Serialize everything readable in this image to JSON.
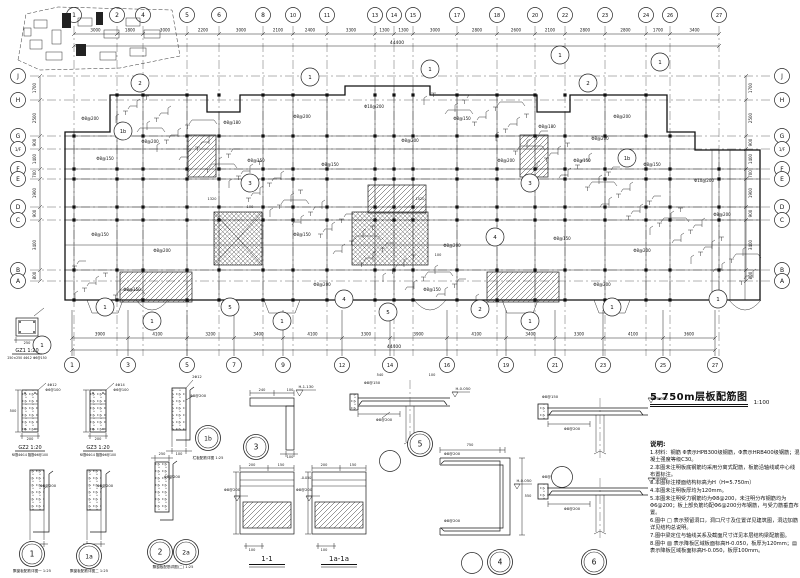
{
  "title_block": {
    "text": "5.750m层板配筋图",
    "scale": "1:100"
  },
  "grid": {
    "top": [
      {
        "l": "1",
        "x": 74
      },
      {
        "l": "2",
        "x": 117
      },
      {
        "l": "4",
        "x": 143
      },
      {
        "l": "5",
        "x": 187
      },
      {
        "l": "6",
        "x": 219
      },
      {
        "l": "8",
        "x": 263
      },
      {
        "l": "10",
        "x": 293
      },
      {
        "l": "11",
        "x": 327
      },
      {
        "l": "13",
        "x": 375
      },
      {
        "l": "14",
        "x": 394
      },
      {
        "l": "15",
        "x": 413
      },
      {
        "l": "17",
        "x": 457
      },
      {
        "l": "18",
        "x": 497
      },
      {
        "l": "20",
        "x": 535
      },
      {
        "l": "22",
        "x": 565
      },
      {
        "l": "23",
        "x": 605
      },
      {
        "l": "24",
        "x": 646
      },
      {
        "l": "26",
        "x": 670
      },
      {
        "l": "27",
        "x": 719
      }
    ],
    "bottom": [
      {
        "l": "1",
        "x": 72
      },
      {
        "l": "3",
        "x": 128
      },
      {
        "l": "5",
        "x": 187
      },
      {
        "l": "7",
        "x": 234
      },
      {
        "l": "9",
        "x": 283
      },
      {
        "l": "12",
        "x": 342
      },
      {
        "l": "14",
        "x": 390
      },
      {
        "l": "16",
        "x": 447
      },
      {
        "l": "19",
        "x": 506
      },
      {
        "l": "21",
        "x": 555
      },
      {
        "l": "23",
        "x": 603
      },
      {
        "l": "25",
        "x": 663
      },
      {
        "l": "27",
        "x": 715
      }
    ],
    "left": [
      {
        "l": "J",
        "y": 76
      },
      {
        "l": "H",
        "y": 100
      },
      {
        "l": "G",
        "y": 136
      },
      {
        "l": "1/F",
        "y": 149
      },
      {
        "l": "F",
        "y": 169
      },
      {
        "l": "E",
        "y": 179
      },
      {
        "l": "D",
        "y": 207
      },
      {
        "l": "C",
        "y": 220
      },
      {
        "l": "B",
        "y": 270
      },
      {
        "l": "A",
        "y": 281
      }
    ],
    "right": [
      {
        "l": "J",
        "y": 76
      },
      {
        "l": "H",
        "y": 100
      },
      {
        "l": "G",
        "y": 136
      },
      {
        "l": "1/F",
        "y": 149
      },
      {
        "l": "F",
        "y": 169
      },
      {
        "l": "E",
        "y": 179
      },
      {
        "l": "D",
        "y": 207
      },
      {
        "l": "C",
        "y": 220
      },
      {
        "l": "B",
        "y": 270
      },
      {
        "l": "A",
        "y": 281
      }
    ]
  },
  "dims": {
    "top_row": [
      "3000",
      "1800",
      "3000",
      "2200",
      "3000",
      "2100",
      "2400",
      "3300",
      "1300",
      "1300",
      "3000",
      "2800",
      "2600",
      "2100",
      "2800",
      "2800",
      "1700",
      "3400"
    ],
    "top_total": "44400",
    "bottom_row": [
      "3900",
      "4100",
      "3200",
      "3400",
      "4100",
      "3300",
      "3900",
      "4100",
      "3400",
      "3300",
      "4100",
      "3600"
    ],
    "bottom_total": "44400",
    "left_row": [
      "1700",
      "2500",
      "900",
      "1400",
      "700",
      "1900",
      "900",
      "3400",
      "800"
    ],
    "right_row": [
      "1700",
      "2500",
      "900",
      "1400",
      "700",
      "1900",
      "900",
      "3400",
      "800"
    ]
  },
  "plan": {
    "callouts": [
      {
        "l": "1",
        "x": 105,
        "y": 307
      },
      {
        "l": "1",
        "x": 152,
        "y": 321
      },
      {
        "l": "5",
        "x": 230,
        "y": 307
      },
      {
        "l": "1",
        "x": 282,
        "y": 321
      },
      {
        "l": "4",
        "x": 344,
        "y": 299
      },
      {
        "l": "5",
        "x": 388,
        "y": 312
      },
      {
        "l": "2",
        "x": 480,
        "y": 309
      },
      {
        "l": "1",
        "x": 530,
        "y": 321
      },
      {
        "l": "1",
        "x": 612,
        "y": 307
      },
      {
        "l": "1",
        "x": 718,
        "y": 299
      },
      {
        "l": "2",
        "x": 140,
        "y": 83
      },
      {
        "l": "1",
        "x": 310,
        "y": 77
      },
      {
        "l": "1",
        "x": 430,
        "y": 69
      },
      {
        "l": "1",
        "x": 560,
        "y": 55
      },
      {
        "l": "2",
        "x": 588,
        "y": 83
      },
      {
        "l": "1",
        "x": 660,
        "y": 62
      },
      {
        "l": "1b",
        "x": 123,
        "y": 131
      },
      {
        "l": "1b",
        "x": 627,
        "y": 158
      },
      {
        "l": "3",
        "x": 250,
        "y": 183
      },
      {
        "l": "3",
        "x": 530,
        "y": 183
      },
      {
        "l": "1",
        "x": 42,
        "y": 345
      },
      {
        "l": "4",
        "x": 495,
        "y": 237
      }
    ]
  },
  "annotations": [
    {
      "t": "Φ8@150",
      "x": 105,
      "y": 160
    },
    {
      "t": "Φ8@200",
      "x": 150,
      "y": 143
    },
    {
      "t": "Φ8@180",
      "x": 232,
      "y": 124
    },
    {
      "t": "Φ8@150",
      "x": 256,
      "y": 162
    },
    {
      "t": "Φ8@200",
      "x": 302,
      "y": 118
    },
    {
      "t": "Φ8@150",
      "x": 330,
      "y": 166
    },
    {
      "t": "Φ10@200",
      "x": 374,
      "y": 108
    },
    {
      "t": "Φ8@200",
      "x": 410,
      "y": 142
    },
    {
      "t": "Φ8@150",
      "x": 462,
      "y": 120
    },
    {
      "t": "Φ8@200",
      "x": 506,
      "y": 162
    },
    {
      "t": "Φ8@180",
      "x": 547,
      "y": 128
    },
    {
      "t": "Φ8@150",
      "x": 582,
      "y": 162
    },
    {
      "t": "Φ8@200",
      "x": 622,
      "y": 118
    },
    {
      "t": "Φ8@150",
      "x": 652,
      "y": 166
    },
    {
      "t": "Φ10@200",
      "x": 704,
      "y": 182
    },
    {
      "t": "Φ8@200",
      "x": 722,
      "y": 216
    },
    {
      "t": "Φ8@150",
      "x": 100,
      "y": 236
    },
    {
      "t": "Φ8@200",
      "x": 162,
      "y": 252
    },
    {
      "t": "Φ8@150",
      "x": 302,
      "y": 236
    },
    {
      "t": "Φ8@200",
      "x": 452,
      "y": 247
    },
    {
      "t": "Φ8@150",
      "x": 562,
      "y": 240
    },
    {
      "t": "Φ8@200",
      "x": 642,
      "y": 252
    },
    {
      "t": "Φ8@150",
      "x": 132,
      "y": 291
    },
    {
      "t": "Φ8@200",
      "x": 322,
      "y": 286
    },
    {
      "t": "Φ8@150",
      "x": 432,
      "y": 291
    },
    {
      "t": "Φ8@200",
      "x": 602,
      "y": 286
    },
    {
      "t": "Φ8@200",
      "x": 90,
      "y": 120
    },
    {
      "t": "Φ8@200",
      "x": 600,
      "y": 140
    },
    {
      "t": "1320",
      "x": 212,
      "y": 200,
      "s": 3.5
    },
    {
      "t": "100",
      "x": 250,
      "y": 208,
      "s": 3.5
    },
    {
      "t": "1520",
      "x": 420,
      "y": 200,
      "s": 3.5
    },
    {
      "t": "100",
      "x": 438,
      "y": 256,
      "s": 3.5
    },
    {
      "t": "Φ8@200",
      "x": 48,
      "y": 487,
      "s": 3.8
    },
    {
      "t": "Φ8@200",
      "x": 105,
      "y": 487,
      "s": 3.8
    },
    {
      "t": "100",
      "x": 37,
      "y": 548,
      "s": 3.5
    },
    {
      "t": "100",
      "x": 94,
      "y": 548,
      "s": 3.5
    },
    {
      "t": "4Φ12",
      "x": 52,
      "y": 386,
      "s": 3.5
    },
    {
      "t": "Φ6@100",
      "x": 53,
      "y": 391,
      "s": 3.5
    },
    {
      "t": "4Φ14",
      "x": 120,
      "y": 386,
      "s": 3.5
    },
    {
      "t": "Φ6@100",
      "x": 121,
      "y": 391,
      "s": 3.5
    },
    {
      "t": "250",
      "x": 27,
      "y": 344,
      "s": 3.5
    },
    {
      "t": "500",
      "x": 13,
      "y": 412,
      "s": 3.5
    },
    {
      "t": "200",
      "x": 30,
      "y": 440,
      "s": 3.5
    },
    {
      "t": "200",
      "x": 98,
      "y": 440,
      "s": 3.5
    },
    {
      "t": "250",
      "x": 162,
      "y": 455,
      "s": 3.5
    },
    {
      "t": "Φ8@200",
      "x": 172,
      "y": 478,
      "s": 3.8
    },
    {
      "t": "Φ8@200",
      "x": 198,
      "y": 397,
      "s": 3.8
    },
    {
      "t": "2Φ12",
      "x": 197,
      "y": 378,
      "s": 3.5
    },
    {
      "t": "100",
      "x": 179,
      "y": 455,
      "s": 3.5
    },
    {
      "t": "240",
      "x": 262,
      "y": 391,
      "s": 3.5
    },
    {
      "t": "100",
      "x": 290,
      "y": 391,
      "s": 3.5
    },
    {
      "t": "100",
      "x": 290,
      "y": 458,
      "s": 3.5
    },
    {
      "t": "H-1.130",
      "x": 306,
      "y": 388,
      "s": 3.8
    },
    {
      "t": "Φ8@200",
      "x": 384,
      "y": 421,
      "s": 3.8
    },
    {
      "t": "Φ8@150",
      "x": 372,
      "y": 384,
      "s": 3.8
    },
    {
      "t": "H-0.050",
      "x": 463,
      "y": 390,
      "s": 3.8
    },
    {
      "t": "540",
      "x": 380,
      "y": 376,
      "s": 3.5
    },
    {
      "t": "100",
      "x": 432,
      "y": 376,
      "s": 3.5
    },
    {
      "t": "Φ8@200",
      "x": 232,
      "y": 491,
      "s": 3.8
    },
    {
      "t": "200",
      "x": 252,
      "y": 466,
      "s": 3.5
    },
    {
      "t": "150",
      "x": 281,
      "y": 466,
      "s": 3.5
    },
    {
      "t": "100",
      "x": 252,
      "y": 551,
      "s": 3.5
    },
    {
      "t": "Φ8@200",
      "x": 304,
      "y": 491,
      "s": 3.8
    },
    {
      "t": "200",
      "x": 324,
      "y": 466,
      "s": 3.5
    },
    {
      "t": "150",
      "x": 353,
      "y": 466,
      "s": 3.5
    },
    {
      "t": "100",
      "x": 324,
      "y": 551,
      "s": 3.5
    },
    {
      "t": "-0.050",
      "x": 306,
      "y": 479,
      "s": 3.3
    },
    {
      "t": "750",
      "x": 470,
      "y": 446,
      "s": 3.5
    },
    {
      "t": "550",
      "x": 528,
      "y": 497,
      "s": 3.5
    },
    {
      "t": "Φ8@200",
      "x": 452,
      "y": 455,
      "s": 3.8
    },
    {
      "t": "Φ8@200",
      "x": 452,
      "y": 522,
      "s": 3.8
    },
    {
      "t": "H-0.050",
      "x": 524,
      "y": 482,
      "s": 3.8
    },
    {
      "t": "Φ8@200",
      "x": 572,
      "y": 430,
      "s": 3.8
    },
    {
      "t": "H-1.050",
      "x": 660,
      "y": 400,
      "s": 3.8
    },
    {
      "t": "Φ8@200",
      "x": 572,
      "y": 510,
      "s": 3.8
    },
    {
      "t": "H-0.050",
      "x": 660,
      "y": 480,
      "s": 3.8
    },
    {
      "t": "Φ8@150",
      "x": 550,
      "y": 398,
      "s": 3.8
    },
    {
      "t": "Φ8@150",
      "x": 550,
      "y": 478,
      "s": 3.8
    }
  ],
  "details": {
    "bubbles": [
      {
        "id": "1",
        "x": 32,
        "y": 554,
        "cap": "飘窗板配筋详图一 1:25",
        "capx": 32,
        "capy": 572
      },
      {
        "id": "1a",
        "x": 89,
        "y": 556,
        "cap": "飘窗板配筋详图二 1:25",
        "capx": 89,
        "capy": 572
      },
      {
        "id": "2",
        "x": 160,
        "y": 552,
        "cap": "飘窗板配筋详图(二) 1:25",
        "capx": 173,
        "capy": 568
      },
      {
        "id": "2a",
        "x": 186,
        "y": 552
      },
      {
        "id": "1b",
        "x": 208,
        "y": 438,
        "cap": "栏板配筋详图 1:25",
        "capx": 208,
        "capy": 459
      },
      {
        "id": "3",
        "x": 256,
        "y": 447
      },
      {
        "id": "5",
        "x": 420,
        "y": 444
      },
      {
        "id": "4",
        "x": 500,
        "y": 562
      },
      {
        "id": "6",
        "x": 594,
        "y": 562
      }
    ],
    "plain_circles": [
      {
        "x": 390,
        "y": 461
      },
      {
        "x": 472,
        "y": 563
      },
      {
        "x": 562,
        "y": 477
      }
    ],
    "section_labels": [
      {
        "t": "1-1",
        "x": 267,
        "y": 561
      },
      {
        "t": "1a-1a",
        "x": 339,
        "y": 561
      }
    ],
    "gz": [
      {
        "label": "GZ1 1:20",
        "sub": "250×250 4Φ12 Φ6@150",
        "x": 27,
        "y": 352
      },
      {
        "label": "GZ2 1:20",
        "sub": "纵筋4Φ14 箍筋Φ6@100",
        "x": 30,
        "y": 449
      },
      {
        "label": "GZ3 1:20",
        "sub": "纵筋6Φ14 箍筋Φ6@100",
        "x": 98,
        "y": 449
      }
    ]
  },
  "notes": {
    "title": "说明:",
    "items": [
      "1.材料：钢筋 Φ表示HPB300级钢筋，Φ表示HRB400级钢筋；混凝土强度等级C30。",
      "2.本图未注明板底钢筋均采用分离式配筋，板筋沿轴线或中心线布置标注。",
      "3.本图标注楼面结构标高为H（H=5.750m）",
      "4.本图未注明板厚均为120mm。",
      "5.本图未注明受力钢筋均为Φ8@200，未注明分布钢筋均为Φ6@200；板上部负筋均配Φ6@200分布钢筋，与受力筋垂直布置。",
      "6.图中 □ 表示预留洞口，洞口尺寸及位置详见建筑图，洞边加筋详见结构总说明。",
      "7.图中梁定位与轴线关系及截面尺寸详见本层结构梁配筋图。",
      "8.图中 ▨ 表示降板区域板面标高H-0.050，板厚为120mm；▤ 表示降板区域板面标高H-0.050，板厚100mm。"
    ]
  }
}
